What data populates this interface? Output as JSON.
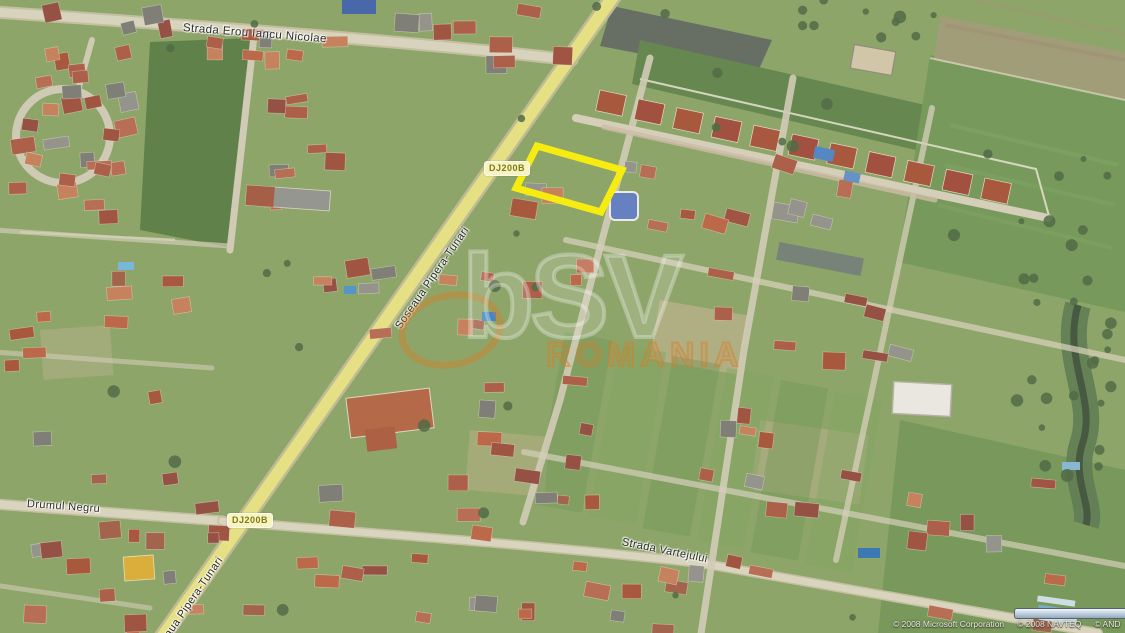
{
  "map": {
    "road_labels": [
      {
        "name": "strada-erou-iancu-nicolae",
        "text": "Strada Erou Iancu Nicolae"
      },
      {
        "name": "soseaua-pipera-tunari-upper",
        "text": "Soseaua Pipera-Tunari"
      },
      {
        "name": "soseaua-pipera-tunari-lower",
        "text": "Soseaua Pipera-Tunari"
      },
      {
        "name": "drumul-negru",
        "text": "Drumul Negru"
      },
      {
        "name": "strada-vartejului",
        "text": "Strada Vartejului"
      }
    ],
    "route_shields": [
      {
        "name": "dj200b-shield-north",
        "text": "DJ200B"
      },
      {
        "name": "dj200b-shield-south",
        "text": "DJ200B"
      }
    ],
    "plot_highlight": {
      "color": "#f8ec00"
    },
    "shield_colors": {
      "background": "#f7f4c2",
      "text": "#7e7b17"
    },
    "watermark": {
      "logo": "bSV",
      "region": "ROMANIA"
    },
    "copyright_segments": [
      "© 2008 Microsoft Corporation",
      "© 2008 NAVTEQ",
      "© AND",
      "©"
    ]
  }
}
